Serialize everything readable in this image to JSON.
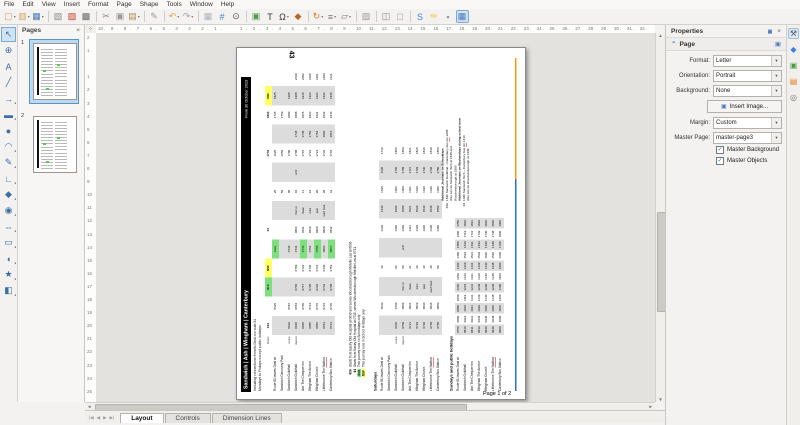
{
  "menu": {
    "items": [
      "File",
      "Edit",
      "View",
      "Insert",
      "Format",
      "Page",
      "Shape",
      "Tools",
      "Window",
      "Help"
    ]
  },
  "toolbar": {
    "buttons": [
      {
        "name": "new-button",
        "glyph": "▢",
        "color": "#caa66a",
        "drop": true
      },
      {
        "name": "open-button",
        "glyph": "▥",
        "color": "#caa66a",
        "drop": true
      },
      {
        "name": "save-button",
        "glyph": "▦",
        "color": "#4a7ab5",
        "drop": true
      },
      {
        "name": "sep",
        "sep": true
      },
      {
        "name": "export-button",
        "glyph": "▧",
        "color": "#888"
      },
      {
        "name": "export-pdf-button",
        "glyph": "▨",
        "color": "#c0392b"
      },
      {
        "name": "print-button",
        "glyph": "▩",
        "color": "#666"
      },
      {
        "name": "sep",
        "sep": true
      },
      {
        "name": "cut-button",
        "glyph": "✂",
        "color": "#888"
      },
      {
        "name": "copy-button",
        "glyph": "▣",
        "color": "#999"
      },
      {
        "name": "paste-button",
        "glyph": "▤",
        "color": "#b08d57",
        "drop": true
      },
      {
        "name": "sep",
        "sep": true
      },
      {
        "name": "clone-formatting-button",
        "glyph": "✎",
        "color": "#999"
      },
      {
        "name": "sep",
        "sep": true
      },
      {
        "name": "undo-button",
        "glyph": "↶",
        "color": "#e8a33d",
        "drop": true
      },
      {
        "name": "redo-button",
        "glyph": "↷",
        "color": "#9aa7b5",
        "drop": true
      },
      {
        "name": "sep",
        "sep": true
      },
      {
        "name": "grid-button",
        "glyph": "▦",
        "color": "#aab4be"
      },
      {
        "name": "helplines-button",
        "glyph": "#",
        "color": "#4a7ab5"
      },
      {
        "name": "zoom-button",
        "glyph": "⊙",
        "color": "#555"
      },
      {
        "name": "sep",
        "sep": true
      },
      {
        "name": "insert-image-button",
        "glyph": "▣",
        "color": "#4a9a4a"
      },
      {
        "name": "insert-textbox-button",
        "glyph": "T",
        "color": "#333"
      },
      {
        "name": "special-character-button",
        "glyph": "Ω",
        "color": "#333",
        "drop": true
      },
      {
        "name": "insert-media-button",
        "glyph": "◆",
        "color": "#b5651d"
      },
      {
        "name": "sep",
        "sep": true
      },
      {
        "name": "transformations-button",
        "glyph": "↻",
        "color": "#e07b20",
        "drop": true
      },
      {
        "name": "align-button",
        "glyph": "≡",
        "color": "#777",
        "drop": true
      },
      {
        "name": "arrange-button",
        "glyph": "▱",
        "color": "#777",
        "drop": true
      },
      {
        "name": "sep",
        "sep": true
      },
      {
        "name": "shadow-button",
        "glyph": "▨",
        "color": "#999"
      },
      {
        "name": "sep",
        "sep": true
      },
      {
        "name": "group-button",
        "glyph": "◫",
        "color": "#888"
      },
      {
        "name": "ungroup-button",
        "glyph": "◻",
        "color": "#aaa"
      },
      {
        "name": "sep",
        "sep": true
      },
      {
        "name": "fontwork-button",
        "glyph": "S",
        "color": "#3d7fe8"
      },
      {
        "name": "freeform-highlight-button",
        "glyph": "✏",
        "color": "#e8c832"
      },
      {
        "name": "glue-points-button",
        "glyph": "▪",
        "color": "#999"
      },
      {
        "name": "show-draw-functions-button",
        "glyph": "▦",
        "color": "#4a7ab5",
        "active": true
      }
    ]
  },
  "drawtools": [
    {
      "name": "select-tool",
      "glyph": "↖",
      "active": true
    },
    {
      "name": "zoom-tool",
      "glyph": "⊕"
    },
    {
      "name": "text-tool",
      "glyph": "A"
    },
    {
      "name": "line-tool",
      "glyph": "╱"
    },
    {
      "name": "arrow-tool",
      "glyph": "→",
      "drop": true
    },
    {
      "name": "rectangle-tool",
      "glyph": "▬",
      "drop": true
    },
    {
      "name": "ellipse-tool",
      "glyph": "●"
    },
    {
      "name": "arc-tool",
      "glyph": "◠",
      "drop": true
    },
    {
      "name": "curve-tool",
      "glyph": "✎",
      "drop": true
    },
    {
      "name": "connector-tool",
      "glyph": "∟",
      "drop": true
    },
    {
      "name": "basic-shapes-tool",
      "glyph": "◆",
      "drop": true
    },
    {
      "name": "symbol-shapes-tool",
      "glyph": "◉",
      "drop": true
    },
    {
      "name": "block-arrows-tool",
      "glyph": "⇔",
      "drop": true
    },
    {
      "name": "flowchart-tool",
      "glyph": "▭",
      "drop": true
    },
    {
      "name": "callouts-tool",
      "glyph": "◖",
      "drop": true
    },
    {
      "name": "stars-tool",
      "glyph": "★",
      "drop": true
    },
    {
      "name": "threed-objects-tool",
      "glyph": "◧",
      "drop": true
    }
  ],
  "pages_panel": {
    "title": "Pages",
    "close": "×",
    "pages": [
      "1",
      "2"
    ],
    "selected": 0
  },
  "rulers": {
    "h_start": -10,
    "h_end": 32,
    "v_start": -2,
    "v_end": 25
  },
  "scroll": {
    "up": "▲",
    "down": "▼",
    "left": "◄",
    "right": "►"
  },
  "tabs": {
    "nav": [
      "|◀",
      "◀",
      "▶",
      "▶|"
    ],
    "items": [
      "Layout",
      "Controls",
      "Dimension Lines"
    ],
    "active": 0
  },
  "properties": {
    "title": "Properties",
    "close": "×",
    "dock": "▣",
    "section": "Page",
    "collapse": "⌃",
    "fields": [
      {
        "label": "Format:",
        "value": "Letter"
      },
      {
        "label": "Orientation:",
        "value": "Portrait"
      },
      {
        "label": "Background:",
        "value": "None"
      },
      {
        "button": "Insert Image..."
      },
      {
        "label": "Margin:",
        "value": "Custom"
      },
      {
        "label": "Master Page:",
        "value": "master-page3"
      }
    ],
    "checkboxes": [
      {
        "label": "Master Background",
        "checked": true
      },
      {
        "label": "Master Objects",
        "checked": true
      }
    ]
  },
  "sidebar_icons": [
    {
      "name": "properties-deck-icon",
      "glyph": "⚒",
      "color": "#555",
      "active": true
    },
    {
      "name": "shapes-deck-icon",
      "glyph": "◆",
      "color": "#3d7fe8"
    },
    {
      "name": "gallery-deck-icon",
      "glyph": "▣",
      "color": "#4a9a4a"
    },
    {
      "name": "styles-deck-icon",
      "glyph": "▤",
      "color": "#e07b20"
    },
    {
      "name": "navigator-deck-icon",
      "glyph": "◎",
      "color": "#777"
    }
  ],
  "document": {
    "route": "43",
    "title": "Sandwich | Ash | Wingham | Canterbury",
    "effective": "From 30 October 2023",
    "subtitle1": "Including connections from/to Deal on route 81",
    "subtitle2": "Mondays to Fridays except public holidays",
    "footer": "Page 1 of 2",
    "notes_label": "Notes",
    "stops": [
      {
        "label": "Route 81 leaves Deal at",
        "sub": ""
      },
      {
        "label": "Sandwich Discovery Park",
        "sub": ""
      },
      {
        "label": "Sandwich Guildhall",
        "sub": "arrive"
      },
      {
        "label": "Sandwich Guildhall",
        "sub": "depart"
      },
      {
        "label": "Ash The Chequer Inn",
        "sub": ""
      },
      {
        "label": "Wingham The Anchor",
        "sub": ""
      },
      {
        "label": "Wingham Church",
        "sub": ""
      },
      {
        "label": "Littlebourne The Nailbox",
        "sub": ""
      },
      {
        "label": "Canterbury Bus Station",
        "sub": ""
      }
    ],
    "weekday": {
      "note_row": [
        "43A",
        "",
        "g|Sch",
        "y|NSF",
        "",
        "44",
        "",
        "",
        "",
        "1704",
        "",
        "1804",
        "y|NSF",
        ""
      ],
      "grid": [
        [
          "",
          "0625",
          "",
          "",
          "g|Early",
          "",
          "",
          "25",
          "",
          "1625",
          "",
          "1725",
          "1825",
          ""
        ],
        [
          "",
          "",
          "",
          "",
          "",
          "",
          "",
          "59",
          "",
          "1659",
          "",
          "1759",
          "",
          ""
        ],
        [
          "0619",
          "0646",
          "",
          "",
          "0730",
          "",
          "",
          "00",
          "",
          "1700",
          "",
          "1800",
          "1900",
          ""
        ],
        [
          "0640",
          "0654",
          "0704",
          "0709",
          "0734",
          "0804",
          "then at",
          "04",
          "until",
          "1708",
          "1738",
          "1808",
          "1908",
          "2040"
        ],
        [
          "0648",
          "0706",
          "0717",
          "0722",
          "g|0746",
          "0811",
          "these",
          "11",
          "",
          "1715",
          "1745",
          "1815",
          "1915",
          "2052"
        ],
        [
          "0655",
          "0714",
          "0725",
          "0730",
          "0754",
          "0819",
          "mins",
          "19",
          "",
          "1723",
          "1753",
          "1823",
          "1923",
          "2100"
        ],
        [
          "0656",
          "0715",
          "0726",
          "0731",
          "g|0755",
          "0820",
          "past",
          "20",
          "",
          "1724",
          "1754",
          "1824",
          "1924",
          "2101"
        ],
        [
          "0703",
          "0723",
          "0734",
          "0739",
          "0803",
          "0828",
          "each hour",
          "28",
          "",
          "1732",
          "1802",
          "1832",
          "1932",
          "2109"
        ],
        [
          "0714",
          "0735",
          "0748",
          "0753",
          "g|0817",
          "0842",
          "",
          "42",
          "",
          "1746",
          "1816",
          "1846",
          "1946",
          "2121"
        ]
      ]
    },
    "saturday_heading": "Saturdays",
    "saturday": {
      "grid": [
        [
          "",
          "0630",
          "",
          "30",
          "",
          "1330",
          "1430",
          "1530",
          "1630",
          "1730"
        ],
        [
          "",
          "",
          "",
          "",
          "",
          "",
          "",
          "",
          "",
          ""
        ],
        [
          "0636",
          "0706",
          "",
          "06",
          "",
          "1406",
          "1506",
          "1606",
          "1706",
          "1806"
        ],
        [
          "0709",
          "0809",
          "then at",
          "09",
          "until",
          "1409",
          "1509",
          "1609",
          "1709",
          "1809"
        ],
        [
          "0721",
          "0821",
          "these",
          "21",
          "",
          "1421",
          "1521",
          "1621",
          "1721",
          "1821"
        ],
        [
          "0729",
          "0829",
          "mins",
          "29",
          "",
          "1429",
          "1529",
          "1629",
          "1729",
          "1829"
        ],
        [
          "0730",
          "0830",
          "past",
          "30",
          "",
          "1430",
          "1530",
          "1630",
          "1730",
          "1830"
        ],
        [
          "0738",
          "0838",
          "each hour",
          "38",
          "",
          "1438",
          "1538",
          "1638",
          "1738",
          "1838"
        ],
        [
          "0750",
          "0850",
          "",
          "50",
          "",
          "1450",
          "1550",
          "1650",
          "1750",
          "1850"
        ]
      ]
    },
    "sunday_heading": "Sundays and public holidays",
    "sunday_stops": [
      {
        "label": "Route 81 leaves Deal at",
        "sub": ""
      },
      {
        "label": "Sandwich Guildhall",
        "sub": ""
      },
      {
        "label": "Ash The Chequer Inn",
        "sub": ""
      },
      {
        "label": "Wingham The Anchor",
        "sub": ""
      },
      {
        "label": "Wingham Church",
        "sub": ""
      },
      {
        "label": "Littlebourne The Nailbox",
        "sub": ""
      },
      {
        "label": "Canterbury Bus Station",
        "sub": ""
      }
    ],
    "sunday": {
      "grid": [
        [
          "0750",
          "0850",
          "0950",
          "1050",
          "1150",
          "1250",
          "1350",
          "1450",
          "1550",
          "1650",
          "1750"
        ],
        [
          "0819",
          "0919",
          "1019",
          "1119",
          "1219",
          "1319",
          "1419",
          "1519",
          "1619",
          "1719",
          "1819"
        ],
        [
          "0831",
          "0931",
          "1031",
          "1131",
          "1231",
          "1331",
          "1431",
          "1531",
          "1631",
          "1731",
          "1831"
        ],
        [
          "0839",
          "0939",
          "1039",
          "1139",
          "1239",
          "1339",
          "1439",
          "1539",
          "1639",
          "1739",
          "1839"
        ],
        [
          "0840",
          "0940",
          "1040",
          "1140",
          "1240",
          "1340",
          "1440",
          "1540",
          "1640",
          "1740",
          "1840"
        ],
        [
          "0848",
          "0948",
          "1048",
          "1148",
          "1248",
          "1348",
          "1448",
          "1548",
          "1648",
          "1748",
          "1848"
        ],
        [
          "0900",
          "1000",
          "1100",
          "1200",
          "1300",
          "1400",
          "1500",
          "1600",
          "1700",
          "1800",
          "1900"
        ]
      ]
    },
    "notes": [
      {
        "code": "43A",
        "text": "Starts from Eastry Old Hospital at 0630 and serves Woodnesborough Melville Lea at 0636"
      },
      {
        "code": "44",
        "text": "Starts from Eastry Old Hospital at 0715, serves Woodnesborough Melville Lea at 0721"
      },
      {
        "code": "g|Sch",
        "text": "This journey runs on Schooldays only"
      },
      {
        "code": "y|NSF",
        "text": "This journey runs in School Holidays only"
      }
    ],
    "additional": [
      {
        "code": "",
        "text": "Additional Journeys on Schooldays",
        "bold": true
      },
      {
        "code": "43A",
        "text": "1530 Sandwich Guildhall – Canterbury bus stn 1605"
      },
      {
        "code": "",
        "text": "Also serves Sandwich Tech at 1545 and"
      },
      {
        "code": "",
        "text": "Woodnesborough at 1550"
      },
      {
        "code": "",
        "text": "Additional Journeys on Wednesdays during school term",
        "bold": true
      },
      {
        "code": "43",
        "text": "1330 Sandwich Tech – Canterbury bus stn 1410"
      },
      {
        "code": "",
        "text": "Also serves Woodnesborough at 1339"
      }
    ],
    "misspelled": [
      "Nailbox",
      "stn"
    ],
    "line_colors": {
      "blue": "#2a6fd6",
      "orange": "#ff9900"
    },
    "highlight_colors": {
      "green": "#7ddf7d",
      "yellow": "#ffff66"
    }
  }
}
